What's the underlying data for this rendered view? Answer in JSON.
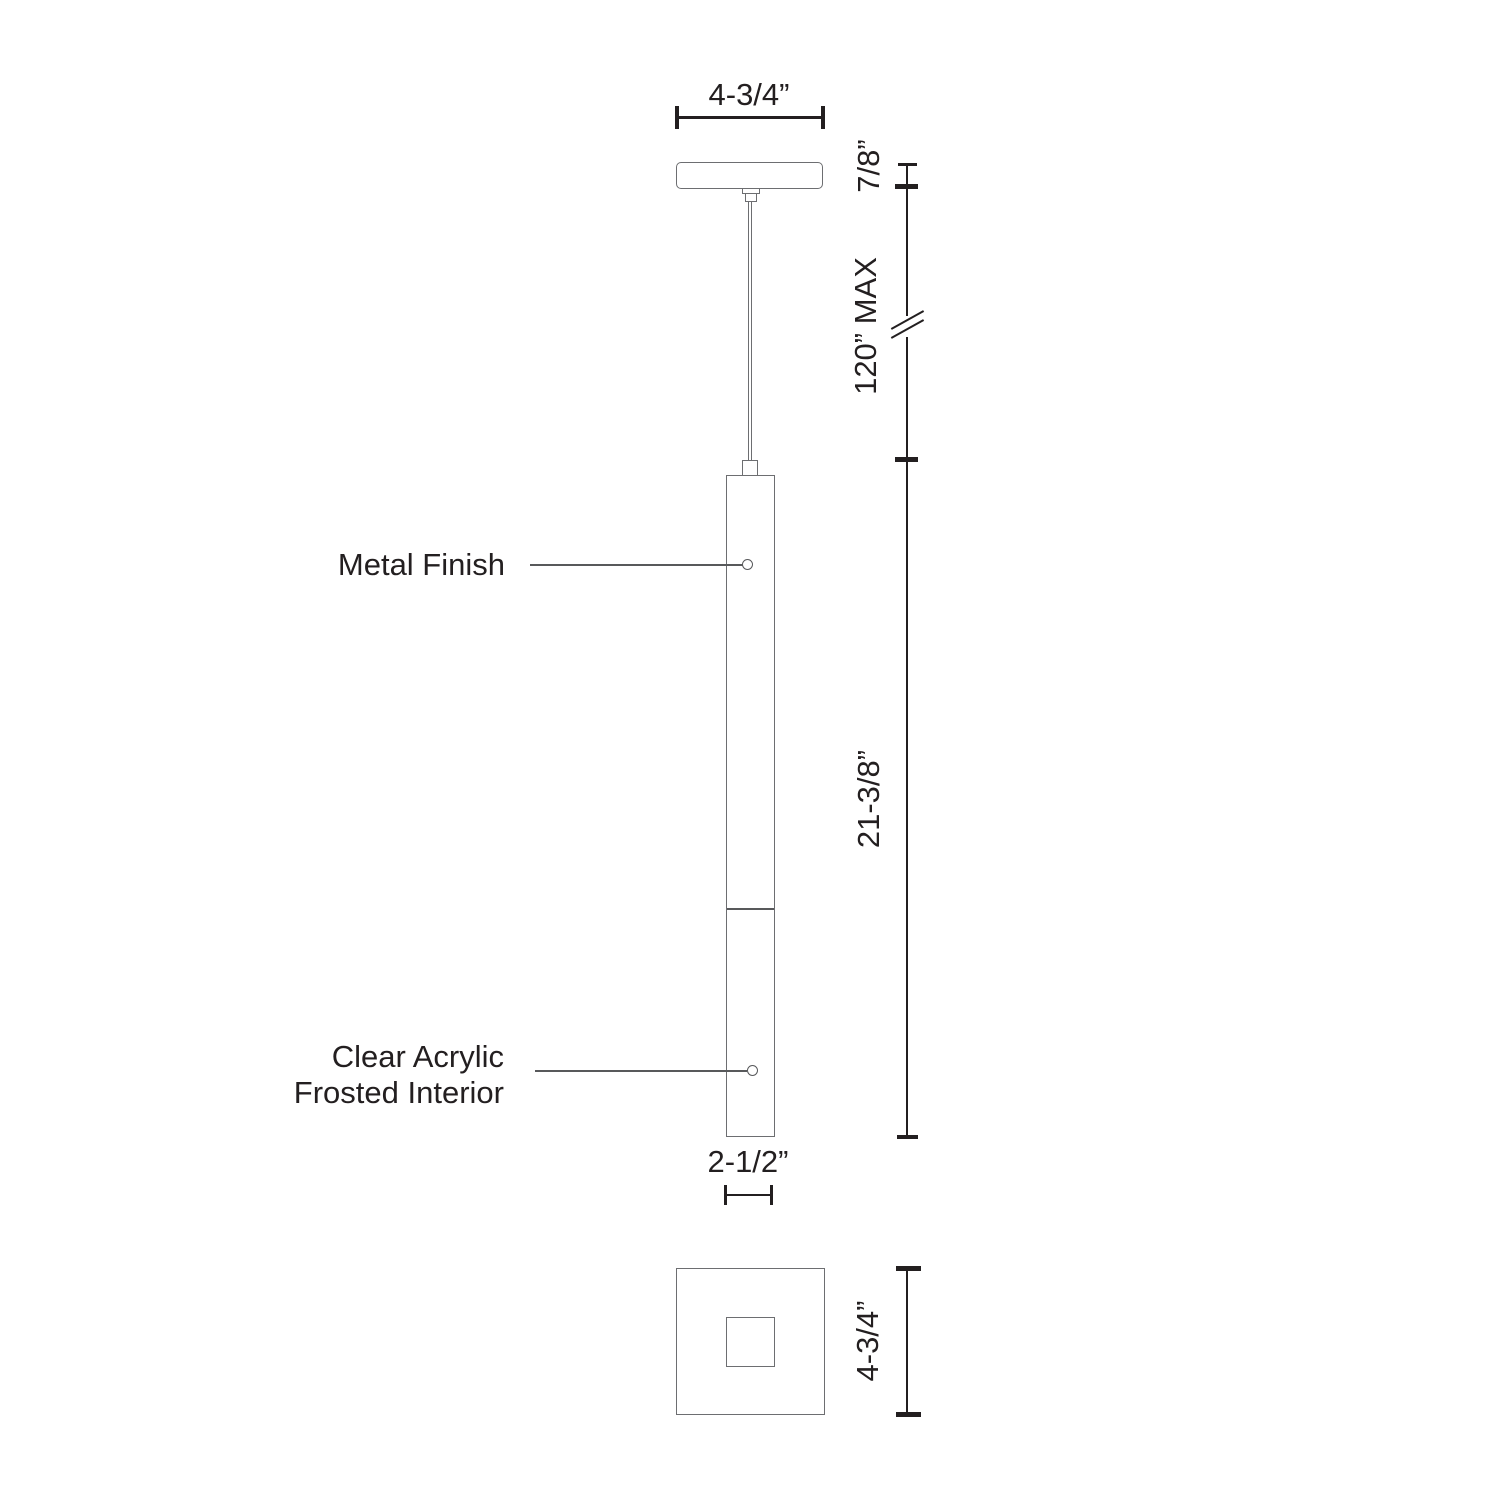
{
  "title": "Pendant fixture technical dimension drawing",
  "labels": {
    "metal_finish": "Metal Finish",
    "acrylic_line1": "Clear Acrylic",
    "acrylic_line2": "Frosted Interior"
  },
  "dimensions": {
    "canopy_width": "4-3/4”",
    "canopy_height": "7/8”",
    "cord_length": "120” MAX",
    "body_height": "21-3/8”",
    "body_width": "2-1/2”",
    "canopy_plan_size": "4-3/4”"
  },
  "colors": {
    "fixture_outline": "#6d6e71",
    "dimension_line": "#231f20",
    "leader_line": "#58595b",
    "background": "#ffffff"
  }
}
